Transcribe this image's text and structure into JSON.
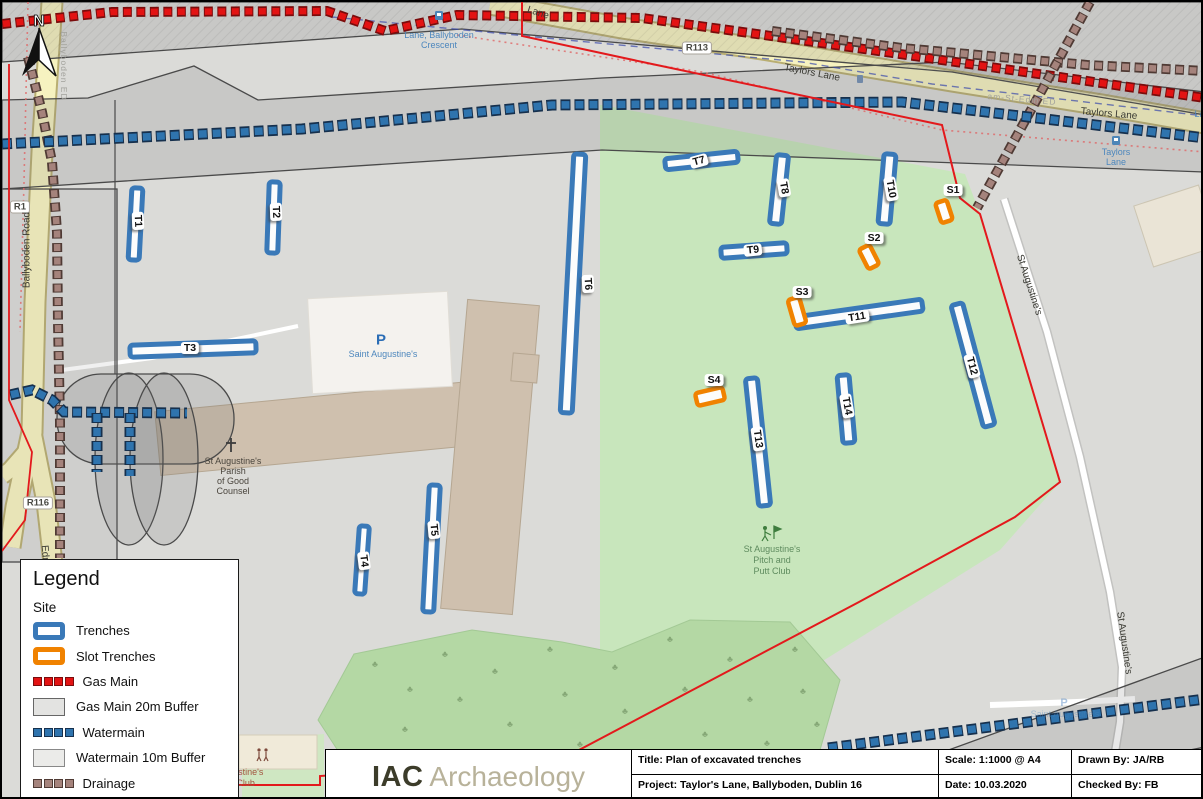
{
  "north": {
    "label": "N"
  },
  "colors": {
    "trench": "#3a79b8",
    "slot": "#f08200",
    "gas": "#e31313",
    "gas_dark": "#7a0c0c",
    "water": "#2f74ae",
    "water_dark": "#16304d",
    "drain": "#a5837c",
    "drain_dark": "#4f3a34",
    "boundary": "#e3191c"
  },
  "trenches": [
    {
      "id": "T1",
      "type": "trench",
      "x": 128,
      "y": 186,
      "w": 11,
      "h": 72,
      "rot": 3,
      "lx": 136,
      "ly": 219,
      "lrot": 88
    },
    {
      "id": "T2",
      "type": "trench",
      "x": 266,
      "y": 180,
      "w": 11,
      "h": 71,
      "rot": 2,
      "lx": 274,
      "ly": 210,
      "lrot": 88
    },
    {
      "id": "T3",
      "type": "trench",
      "x": 128,
      "y": 341,
      "w": 126,
      "h": 12,
      "rot": -2,
      "lx": 188,
      "ly": 346,
      "lrot": 0
    },
    {
      "id": "T4",
      "type": "trench",
      "x": 355,
      "y": 524,
      "w": 10,
      "h": 68,
      "rot": 4,
      "lx": 362,
      "ly": 559,
      "lrot": 83
    },
    {
      "id": "T5",
      "type": "trench",
      "x": 424,
      "y": 483,
      "w": 11,
      "h": 127,
      "rot": 3,
      "lx": 432,
      "ly": 528,
      "lrot": 85
    },
    {
      "id": "T6",
      "type": "trench",
      "x": 565,
      "y": 152,
      "w": 12,
      "h": 259,
      "rot": 3,
      "lx": 586,
      "ly": 282,
      "lrot": 87
    },
    {
      "id": "T7",
      "type": "trench",
      "x": 663,
      "y": 153,
      "w": 73,
      "h": 11,
      "rot": -6,
      "lx": 697,
      "ly": 159,
      "lrot": -15
    },
    {
      "id": "T8",
      "type": "trench",
      "x": 771,
      "y": 153,
      "w": 12,
      "h": 69,
      "rot": 6,
      "lx": 782,
      "ly": 186,
      "lrot": 80
    },
    {
      "id": "T9",
      "type": "trench",
      "x": 719,
      "y": 243,
      "w": 66,
      "h": 11,
      "rot": -4,
      "lx": 751,
      "ly": 248,
      "lrot": -6
    },
    {
      "id": "T10",
      "type": "trench",
      "x": 879,
      "y": 152,
      "w": 12,
      "h": 70,
      "rot": 5,
      "lx": 889,
      "ly": 187,
      "lrot": 80
    },
    {
      "id": "T11",
      "type": "trench",
      "x": 793,
      "y": 306,
      "w": 128,
      "h": 12,
      "rot": -8,
      "lx": 855,
      "ly": 315,
      "lrot": -9
    },
    {
      "id": "T12",
      "type": "trench",
      "x": 965,
      "y": 300,
      "w": 12,
      "h": 126,
      "rot": -15,
      "lx": 970,
      "ly": 364,
      "lrot": 75
    },
    {
      "id": "T13",
      "type": "trench",
      "x": 750,
      "y": 376,
      "w": 12,
      "h": 128,
      "rot": -6,
      "lx": 756,
      "ly": 437,
      "lrot": 82
    },
    {
      "id": "T14",
      "type": "trench",
      "x": 838,
      "y": 373,
      "w": 12,
      "h": 68,
      "rot": -5,
      "lx": 845,
      "ly": 404,
      "lrot": 80
    },
    {
      "id": "S1",
      "type": "slot",
      "x": 936,
      "y": 199,
      "w": 12,
      "h": 21,
      "rot": -18,
      "lx": 951,
      "ly": 188,
      "lrot": 0
    },
    {
      "id": "S2",
      "type": "slot",
      "x": 861,
      "y": 244,
      "w": 12,
      "h": 22,
      "rot": -27,
      "lx": 872,
      "ly": 236,
      "lrot": 0
    },
    {
      "id": "S3",
      "type": "slot",
      "x": 789,
      "y": 296,
      "w": 12,
      "h": 27,
      "rot": -16,
      "lx": 800,
      "ly": 290,
      "lrot": 0
    },
    {
      "id": "S4",
      "type": "slot",
      "x": 694,
      "y": 388,
      "w": 28,
      "h": 13,
      "rot": -13,
      "lx": 712,
      "ly": 378,
      "lrot": 0
    }
  ],
  "map": {
    "labels": [
      {
        "text": "R113",
        "x": 695,
        "y": 46,
        "rot": 0,
        "cls": "badge"
      },
      {
        "text": "R1",
        "x": 18,
        "y": 205,
        "rot": 0,
        "cls": "badge"
      },
      {
        "text": "R116",
        "x": 36,
        "y": 501,
        "rot": 0,
        "cls": "badge"
      },
      {
        "text": "Taylors Lane",
        "x": 810,
        "y": 71,
        "rot": 11,
        "cls": "road"
      },
      {
        "text": "Taylors Lane",
        "x": 1107,
        "y": 112,
        "rot": 5,
        "cls": "road"
      },
      {
        "text": "Lane",
        "x": 536,
        "y": 11,
        "rot": 18,
        "cls": "road"
      },
      {
        "text": "Ballyboden Road",
        "x": 25,
        "y": 248,
        "rot": -90,
        "cls": "road"
      },
      {
        "text": "Edmondstown Road",
        "x": 46,
        "y": 588,
        "rot": 85,
        "cls": "road"
      },
      {
        "text": "St Augustine's",
        "x": 1027,
        "y": 283,
        "rot": 72,
        "cls": "road"
      },
      {
        "text": "St Augustine's",
        "x": 1122,
        "y": 641,
        "rot": 82,
        "cls": "road"
      },
      {
        "text": "Ballyboden ED",
        "x": 62,
        "y": 64,
        "rot": 90,
        "cls": "admin"
      },
      {
        "text": "am-St-Edm ED",
        "x": 1020,
        "y": 97,
        "rot": 5,
        "cls": "admin"
      },
      {
        "text": "Lane, Ballyboden",
        "x": 437,
        "y": 33,
        "rot": 0,
        "cls": "transit"
      },
      {
        "text": "Crescent",
        "x": 437,
        "y": 43,
        "rot": 0,
        "cls": "transit"
      },
      {
        "text": "Taylors",
        "x": 1114,
        "y": 150,
        "rot": 0,
        "cls": "transit"
      },
      {
        "text": "Lane",
        "x": 1114,
        "y": 160,
        "rot": 0,
        "cls": "transit"
      },
      {
        "text": "Lan",
        "x": 1200,
        "y": 112,
        "rot": 0,
        "cls": "transit"
      },
      {
        "text": "P",
        "x": 379,
        "y": 338,
        "rot": 0,
        "cls": "poi-parking"
      },
      {
        "text": "Saint Augustine's",
        "x": 381,
        "y": 352,
        "rot": 0,
        "cls": "poi-blue"
      },
      {
        "text": "St Augustine's",
        "x": 231,
        "y": 459,
        "rot": 0,
        "cls": "poi-dark"
      },
      {
        "text": "Parish",
        "x": 231,
        "y": 469,
        "rot": 0,
        "cls": "poi-dark"
      },
      {
        "text": "of Good",
        "x": 231,
        "y": 479,
        "rot": 0,
        "cls": "poi-dark"
      },
      {
        "text": "Counsel",
        "x": 231,
        "y": 489,
        "rot": 0,
        "cls": "poi-dark"
      },
      {
        "text": "St Augustine's",
        "x": 770,
        "y": 547,
        "rot": 0,
        "cls": "poi-green"
      },
      {
        "text": "Pitch and",
        "x": 770,
        "y": 558,
        "rot": 0,
        "cls": "poi-green"
      },
      {
        "text": "Putt Club",
        "x": 770,
        "y": 569,
        "rot": 0,
        "cls": "poi-green"
      },
      {
        "text": "P",
        "x": 1062,
        "y": 701,
        "rot": 0,
        "cls": "poi-faint-p"
      },
      {
        "text": "Saint Augustine's",
        "x": 1063,
        "y": 712,
        "rot": 0,
        "cls": "poi-faint"
      },
      {
        "text": "St Augustine's",
        "x": 233,
        "y": 770,
        "rot": 0,
        "cls": "poi-brown"
      },
      {
        "text": "Youth Club",
        "x": 231,
        "y": 781,
        "rot": 0,
        "cls": "poi-brown"
      }
    ],
    "trees": {
      "glyph": "♣",
      "positions": [
        [
          370,
          665
        ],
        [
          405,
          690
        ],
        [
          400,
          730
        ],
        [
          372,
          768
        ],
        [
          440,
          655
        ],
        [
          455,
          700
        ],
        [
          445,
          760
        ],
        [
          490,
          672
        ],
        [
          505,
          725
        ],
        [
          520,
          770
        ],
        [
          545,
          650
        ],
        [
          560,
          695
        ],
        [
          575,
          745
        ],
        [
          610,
          668
        ],
        [
          620,
          712
        ],
        [
          640,
          760
        ],
        [
          665,
          640
        ],
        [
          680,
          690
        ],
        [
          700,
          735
        ],
        [
          725,
          660
        ],
        [
          745,
          700
        ],
        [
          762,
          744
        ],
        [
          790,
          650
        ],
        [
          798,
          692
        ],
        [
          812,
          725
        ]
      ]
    }
  },
  "legend": {
    "title": "Legend",
    "subtitle": "Site",
    "items": [
      {
        "label": "Trenches",
        "symbol": "trench"
      },
      {
        "label": "Slot Trenches",
        "symbol": "slot"
      },
      {
        "label": "Gas Main",
        "symbol": "gas-dash"
      },
      {
        "label": "Gas Main 20m Buffer",
        "symbol": "gas-buffer"
      },
      {
        "label": "Watermain",
        "symbol": "water-dash"
      },
      {
        "label": "Watermain 10m Buffer",
        "symbol": "water-buffer"
      },
      {
        "label": "Drainage",
        "symbol": "drain-dash"
      }
    ]
  },
  "titleblock": {
    "logo_strong": "IAC",
    "logo_light": "Archaeology",
    "title": "Title: Plan of excavated trenches",
    "scale": "Scale: 1:1000 @ A4",
    "drawn": "Drawn By: JA/RB",
    "project": "Project: Taylor's Lane, Ballyboden, Dublin 16",
    "date": "Date: 10.03.2020",
    "checked": "Checked By: FB"
  }
}
